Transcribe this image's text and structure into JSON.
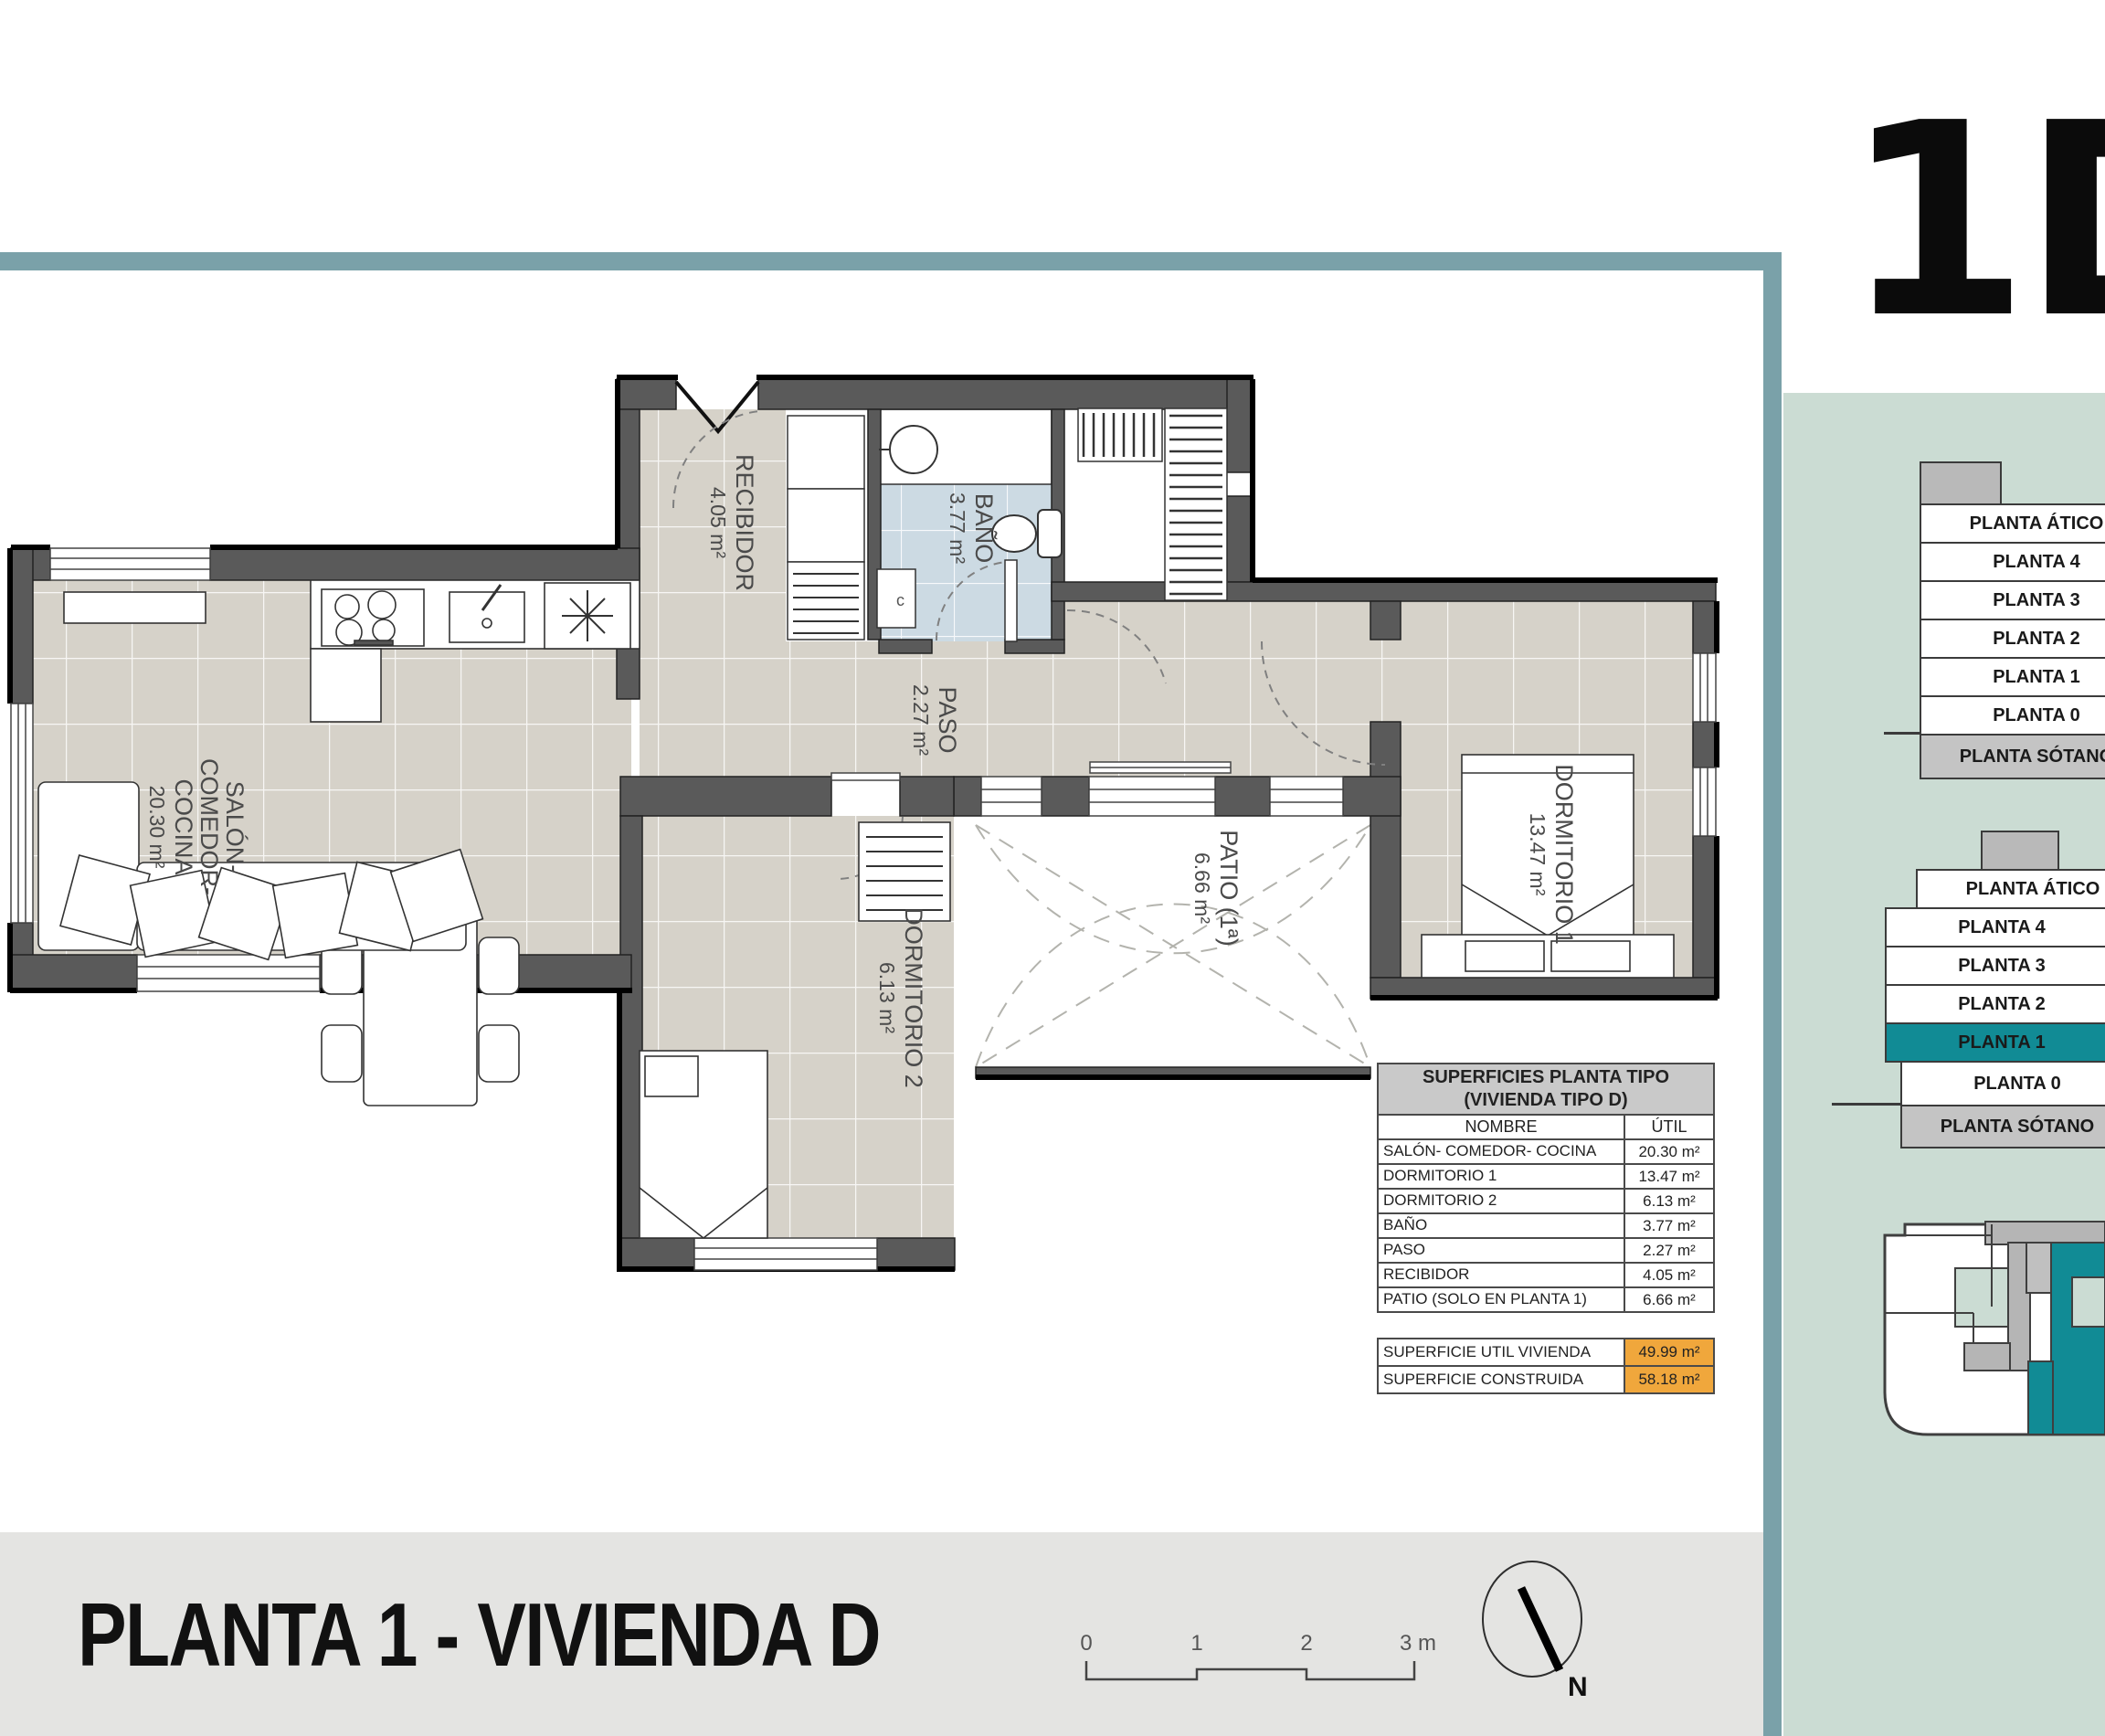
{
  "unit_label": "1D",
  "colors": {
    "accent_teal_bar": "#7aa1a9",
    "sidebar_green": "#cbdcd3",
    "selected_floor_teal": "#118b95",
    "highlight_orange": "#f0a73c",
    "wall_gray": "#5a5a5a",
    "floor_tile_beige": "#d6d2c9",
    "bath_tile_blue": "#ccdae3",
    "footer_band_gray": "#e4e4e2"
  },
  "floor_plan": {
    "rooms": {
      "recibidor": {
        "name": "RECIBIDOR",
        "area": "4.05 m²"
      },
      "bano": {
        "name": "BAÑO",
        "area": "3.77 m²",
        "cabinet_label": "c"
      },
      "paso": {
        "name": "PASO",
        "area": "2.27 m²"
      },
      "salon": {
        "line1": "SALÓN-",
        "line2": "COMEDOR-",
        "line3": "COCINA",
        "area": "20.30 m²"
      },
      "dormitorio2": {
        "name": "DORMITORIO 2",
        "area": "6.13 m²"
      },
      "patio": {
        "name": "PATIO (1ª)",
        "area": "6.66 m²"
      },
      "dormitorio1": {
        "name": "DORMITORIO 1",
        "area": "13.47 m²"
      }
    }
  },
  "surfaces_table": {
    "title_line1": "SUPERFICIES PLANTA TIPO",
    "title_line2": "(VIVIENDA TIPO D)",
    "col_name": "NOMBRE",
    "col_util": "ÚTIL",
    "rows": [
      {
        "name": "SALÓN- COMEDOR- COCINA",
        "util": "20.30 m²"
      },
      {
        "name": "DORMITORIO 1",
        "util": "13.47 m²"
      },
      {
        "name": "DORMITORIO 2",
        "util": "6.13 m²"
      },
      {
        "name": "BAÑO",
        "util": "3.77 m²"
      },
      {
        "name": "PASO",
        "util": "2.27 m²"
      },
      {
        "name": "RECIBIDOR",
        "util": "4.05 m²"
      },
      {
        "name": "PATIO (SOLO EN PLANTA 1)",
        "util": "6.66 m²"
      }
    ],
    "totals": [
      {
        "name": "SUPERFICIE UTIL VIVIENDA",
        "value": "49.99 m²"
      },
      {
        "name": "SUPERFICIE CONSTRUIDA",
        "value": "58.18 m²"
      }
    ]
  },
  "floor_stack_upper": {
    "items": [
      {
        "label": "PLANTA ÁTICO"
      },
      {
        "label": "PLANTA 4"
      },
      {
        "label": "PLANTA 3"
      },
      {
        "label": "PLANTA 2"
      },
      {
        "label": "PLANTA 1"
      },
      {
        "label": "PLANTA 0"
      },
      {
        "label": "PLANTA SÓTANO"
      }
    ]
  },
  "floor_stack_lower": {
    "items": [
      {
        "label": "PLANTA ÁTICO"
      },
      {
        "label": "PLANTA 4"
      },
      {
        "label": "PLANTA 3"
      },
      {
        "label": "PLANTA 2"
      },
      {
        "label": "PLANTA 1",
        "selected": true
      },
      {
        "label": "PLANTA 0"
      },
      {
        "label": "PLANTA SÓTANO"
      }
    ],
    "selected_label": "PLANTA 1"
  },
  "footer": {
    "title": "PLANTA 1 - VIVIENDA D",
    "scale_ticks": [
      "0",
      "1",
      "2",
      "3 m"
    ],
    "north_label": "N"
  }
}
